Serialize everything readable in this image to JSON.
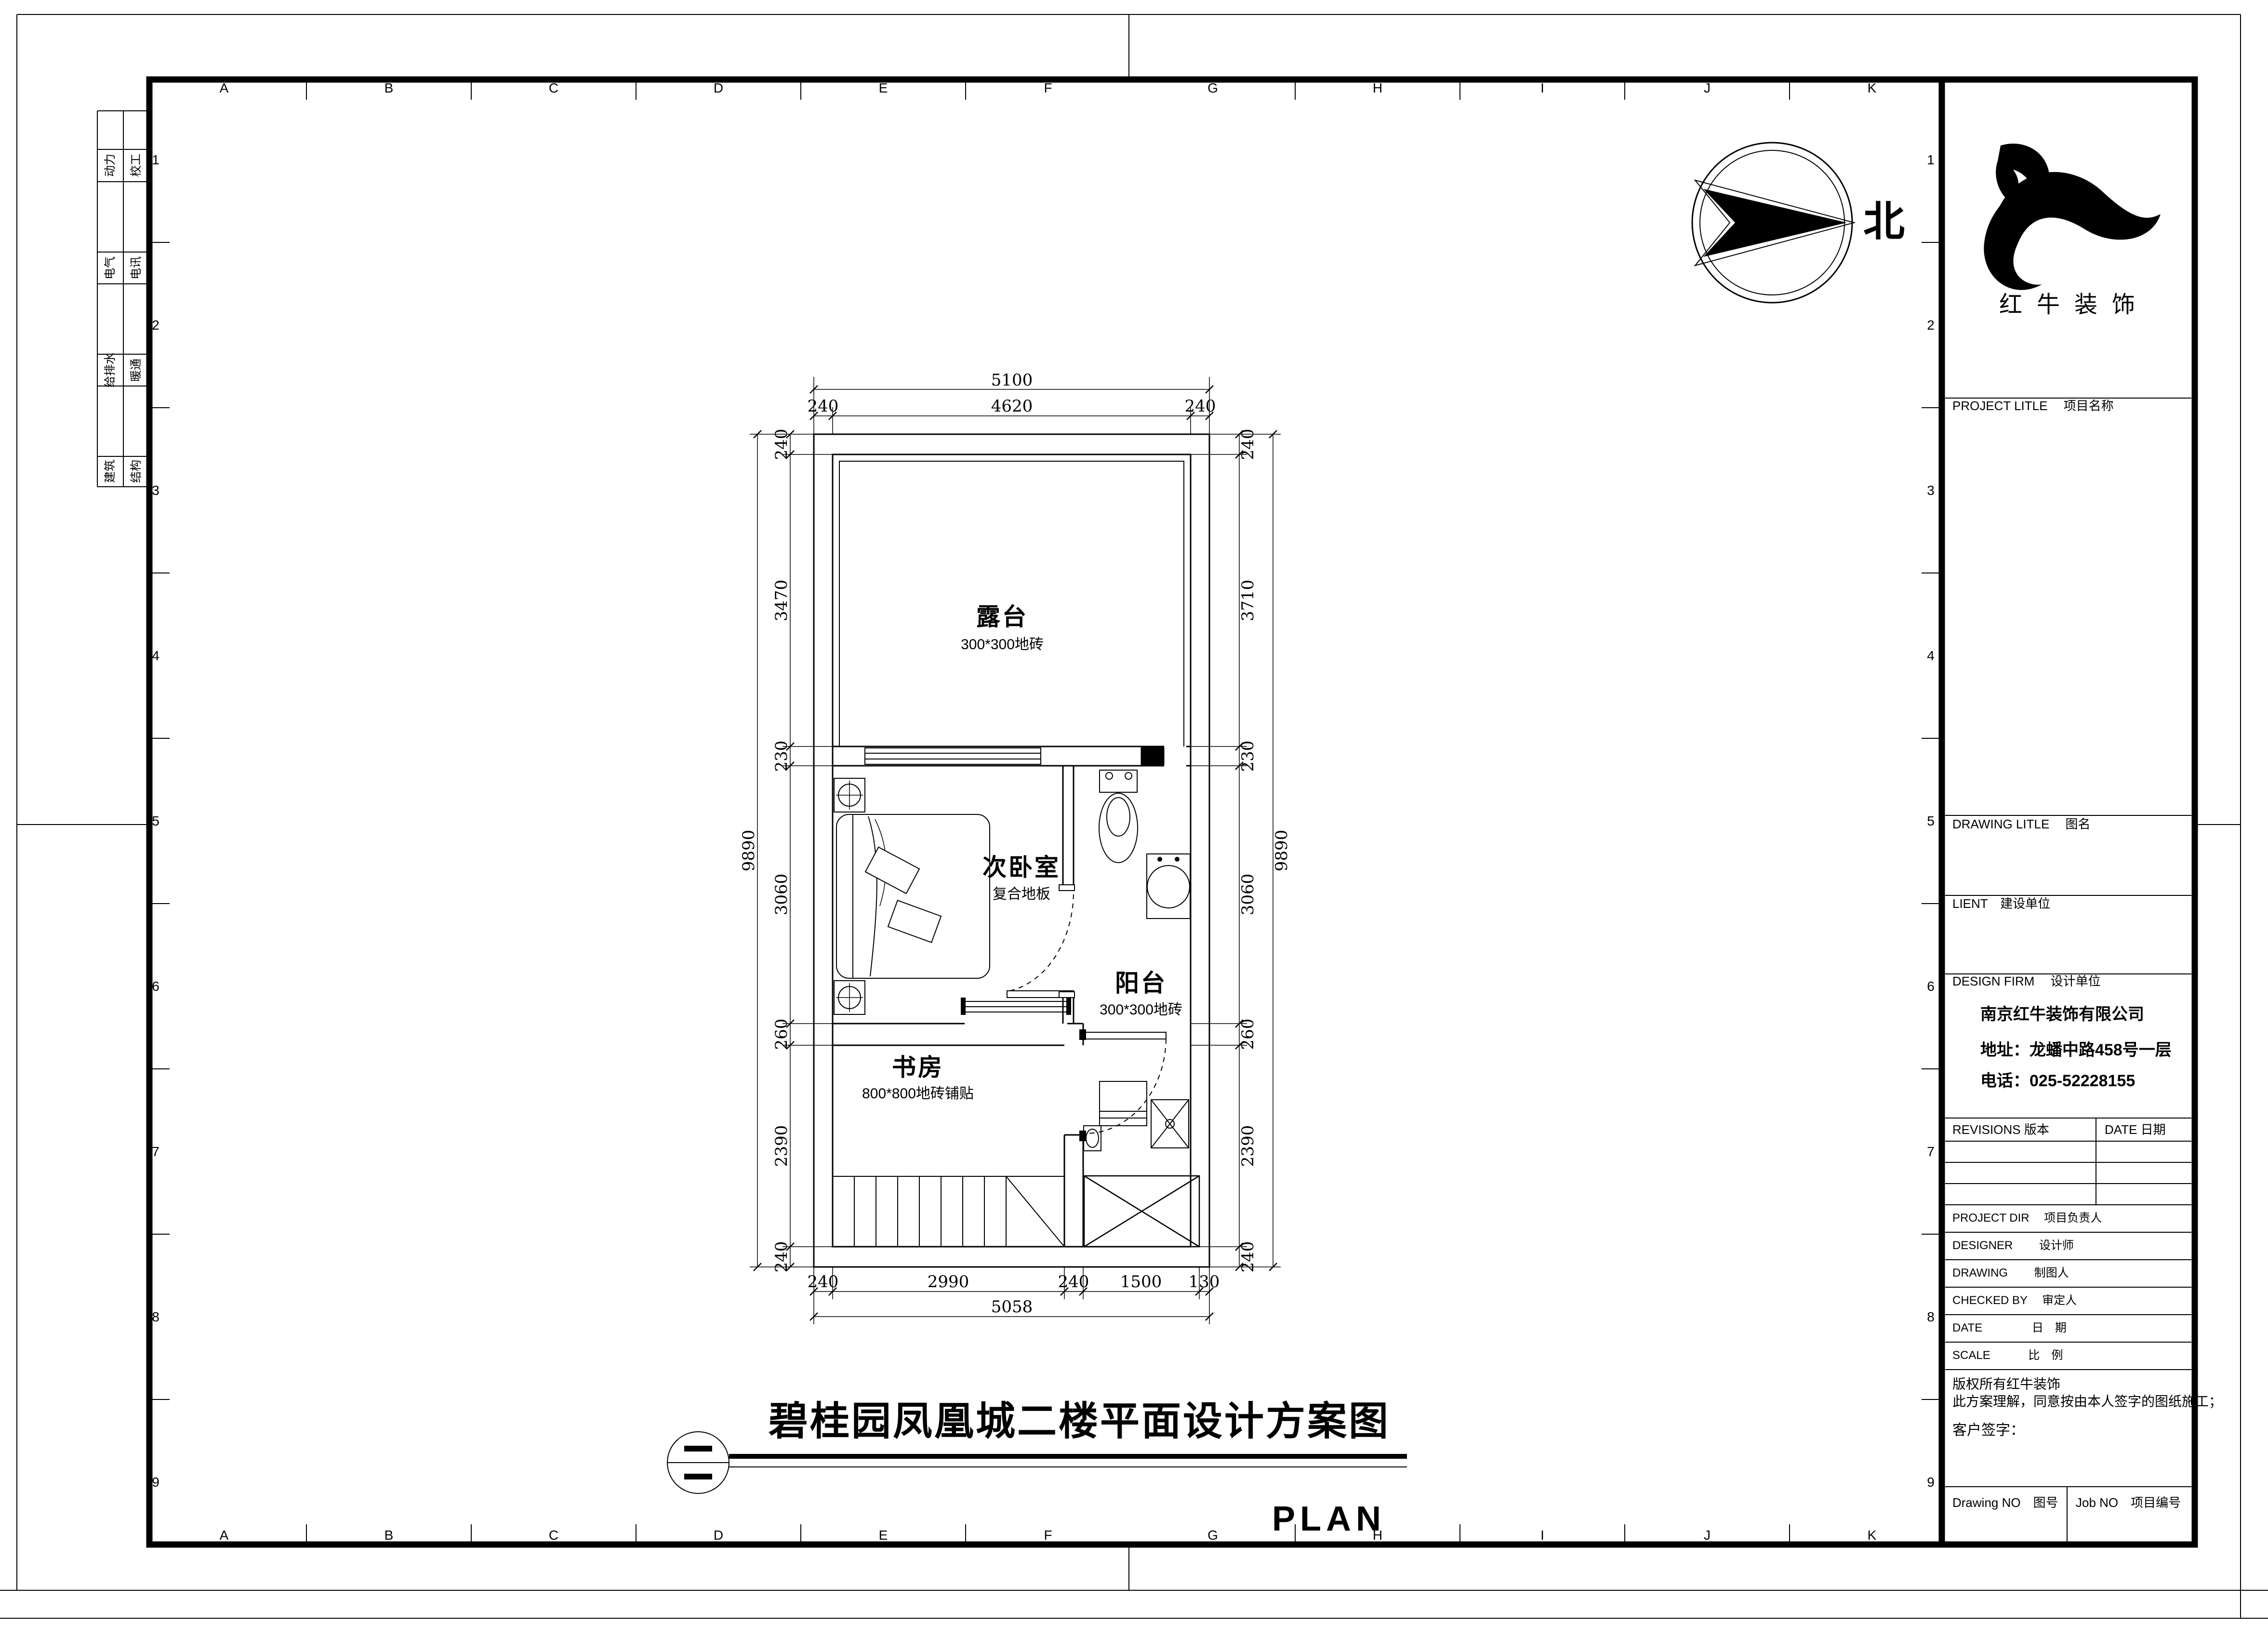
{
  "colors": {
    "ink": "#000000",
    "paper": "#ffffff"
  },
  "grid": {
    "letters": [
      "A",
      "B",
      "C",
      "D",
      "E",
      "F",
      "G",
      "H",
      "I",
      "J",
      "K"
    ],
    "numbers": [
      "1",
      "2",
      "3",
      "4",
      "5",
      "6",
      "7",
      "8",
      "9"
    ]
  },
  "margin_disciplines": {
    "col1": [
      "动力",
      "电气",
      "给排水",
      "建筑"
    ],
    "col2": [
      "校工",
      "电讯",
      "暖通",
      "结构"
    ]
  },
  "north": {
    "label": "北"
  },
  "plan": {
    "rooms": [
      {
        "name": "露台",
        "finish": "300*300地砖"
      },
      {
        "name": "次卧室",
        "finish": "复合地板"
      },
      {
        "name": "阳台",
        "finish": "300*300地砖"
      },
      {
        "name": "书房",
        "finish": "800*800地砖铺贴"
      }
    ],
    "dims": {
      "top": {
        "overall": "5100",
        "segments": [
          "240",
          "4620",
          "240"
        ]
      },
      "bottom": {
        "overall": "5058",
        "segments": [
          "240",
          "2990",
          "240",
          "1500",
          "130"
        ]
      },
      "left": {
        "overall": "9890",
        "segments": [
          "240",
          "3470",
          "230",
          "3060",
          "260",
          "2390",
          "240"
        ]
      },
      "right": {
        "overall": "9890",
        "segments": [
          "240",
          "3710",
          "230",
          "3060",
          "260",
          "2390",
          "240"
        ]
      }
    }
  },
  "drawing_title": {
    "text": "碧桂园凤凰城二楼平面设计方案图",
    "subtitle": "PLAN"
  },
  "title_block": {
    "logo_text": "红牛装饰",
    "project_label": "PROJECT LITLE　 项目名称",
    "drawing_label": "DRAWING LITLE　 图名",
    "client_label": "LIENT　建设单位",
    "design_firm_label": "DESIGN FIRM　 设计单位",
    "firm_name": "南京红牛装饰有限公司",
    "firm_address": "地址：龙蟠中路458号一层",
    "firm_phone": "电话：025-52228155",
    "revisions_label": "REVISIONS 版本",
    "date_label": "DATE 日期",
    "rows": [
      "PROJECT DIR　 项目负责人",
      "DESIGNER　　  设计师",
      "DRAWING　　  制图人",
      "CHECKED BY　 审定人",
      "DATE　　　　 日　期",
      "SCALE　　　  比　例"
    ],
    "copyright_line1": "版权所有红牛装饰",
    "copyright_line2": "此方案理解，同意按由本人签字的图纸施工；",
    "signature_label": "客户签字：",
    "drawing_no_label": "Drawing NO　图号",
    "job_no_label": "Job NO　项目编号"
  }
}
